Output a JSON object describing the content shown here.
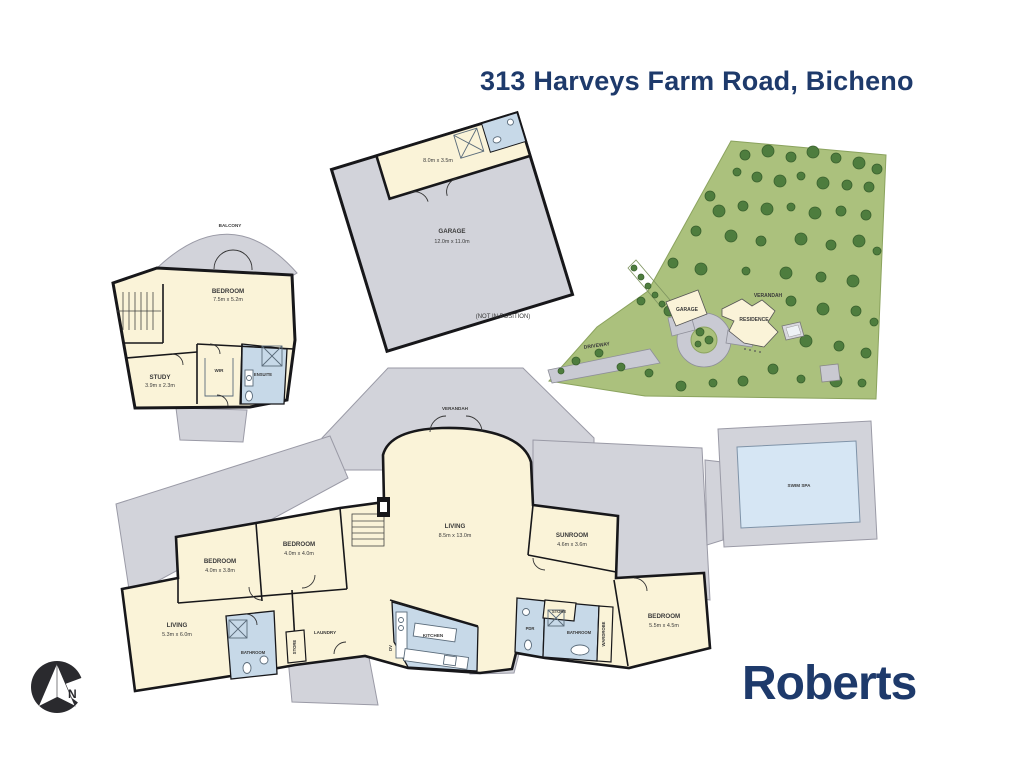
{
  "title": "313 Harveys Farm Road, Bicheno",
  "brand": "Roberts",
  "compass": {
    "north_label": "N"
  },
  "colors": {
    "navy": "#1e3a6b",
    "room_cream": "#faf3d8",
    "verandah_gray": "#d2d3da",
    "wet_area_blue": "#c7d9e8",
    "spa_water_blue": "#d6e6f4",
    "site_green": "#abc17d",
    "tree_green": "#4e7d3e",
    "wall_black": "#17171a"
  },
  "upper_plan": {
    "balcony_label": "BALCONY",
    "bedroom": {
      "name": "BEDROOM",
      "dims": "7.5m x 5.2m"
    },
    "study": {
      "name": "STUDY",
      "dims": "3.9m x 2.3m"
    },
    "wir_label": "WIR",
    "ensuite_label": "ENSUITE"
  },
  "garage_plan": {
    "garage": {
      "name": "GARAGE",
      "dims": "12.0m x 11.0m"
    },
    "storage_dims": "8.0m x 3.5m",
    "note": "(NOT IN POSITION)"
  },
  "site_plan": {
    "driveway_label": "DRIVEWAY",
    "garage_label": "GARAGE",
    "residence_label": "RESIDENCE",
    "verandah_label": "VERANDAH",
    "trees": [
      [
        745,
        155,
        5
      ],
      [
        768,
        151,
        6
      ],
      [
        791,
        157,
        5
      ],
      [
        813,
        152,
        6
      ],
      [
        836,
        158,
        5
      ],
      [
        859,
        163,
        6
      ],
      [
        877,
        169,
        5
      ],
      [
        737,
        172,
        4
      ],
      [
        757,
        177,
        5
      ],
      [
        780,
        181,
        6
      ],
      [
        801,
        176,
        4
      ],
      [
        823,
        183,
        6
      ],
      [
        847,
        185,
        5
      ],
      [
        869,
        187,
        5
      ],
      [
        710,
        196,
        5
      ],
      [
        719,
        211,
        6
      ],
      [
        743,
        206,
        5
      ],
      [
        767,
        209,
        6
      ],
      [
        791,
        207,
        4
      ],
      [
        815,
        213,
        6
      ],
      [
        841,
        211,
        5
      ],
      [
        866,
        215,
        5
      ],
      [
        696,
        231,
        5
      ],
      [
        731,
        236,
        6
      ],
      [
        761,
        241,
        5
      ],
      [
        801,
        239,
        6
      ],
      [
        831,
        245,
        5
      ],
      [
        859,
        241,
        6
      ],
      [
        877,
        251,
        4
      ],
      [
        673,
        263,
        5
      ],
      [
        701,
        269,
        6
      ],
      [
        746,
        271,
        4
      ],
      [
        786,
        273,
        6
      ],
      [
        821,
        277,
        5
      ],
      [
        853,
        281,
        6
      ],
      [
        641,
        301,
        4
      ],
      [
        669,
        311,
        5
      ],
      [
        791,
        301,
        5
      ],
      [
        823,
        309,
        6
      ],
      [
        856,
        311,
        5
      ],
      [
        874,
        322,
        4
      ],
      [
        806,
        341,
        6
      ],
      [
        839,
        346,
        5
      ],
      [
        866,
        353,
        5
      ],
      [
        773,
        369,
        5
      ],
      [
        743,
        381,
        5
      ],
      [
        801,
        379,
        4
      ],
      [
        836,
        381,
        6
      ],
      [
        862,
        383,
        4
      ],
      [
        649,
        373,
        4
      ],
      [
        621,
        367,
        4
      ],
      [
        599,
        353,
        4
      ],
      [
        576,
        361,
        4
      ],
      [
        561,
        371,
        3
      ],
      [
        681,
        386,
        5
      ],
      [
        713,
        383,
        4
      ],
      [
        634,
        268,
        3
      ],
      [
        641,
        277,
        3
      ],
      [
        648,
        286,
        3
      ],
      [
        655,
        295,
        3
      ],
      [
        662,
        304,
        3
      ],
      [
        700,
        332,
        4
      ],
      [
        709,
        340,
        4
      ],
      [
        698,
        344,
        3
      ]
    ]
  },
  "main_plan": {
    "verandah_label": "VERANDAH",
    "living": {
      "name": "LIVING",
      "dims": "8.5m x 13.0m"
    },
    "bedroom1": {
      "name": "BEDROOM",
      "dims": "4.0m x 3.8m"
    },
    "bedroom2": {
      "name": "BEDROOM",
      "dims": "4.0m x 4.0m"
    },
    "sunroom": {
      "name": "SUNROOM",
      "dims": "4.6m x 3.6m"
    },
    "living2": {
      "name": "LIVING",
      "dims": "5.3m x 6.0m"
    },
    "bathroom1_label": "BATHROOM",
    "laundry_label": "LAUNDRY",
    "store1_label": "STORE",
    "kitchen_label": "KITCHEN",
    "dw_label": "DV",
    "pdr_label": "PDR",
    "store2_label": "STORE",
    "bathroom2_label": "BATHROOM",
    "wardrobe_label": "WARDROBE",
    "bedroom3": {
      "name": "BEDROOM",
      "dims": "5.5m x 4.5m"
    },
    "swim_spa_label": "SWIM SPA"
  }
}
